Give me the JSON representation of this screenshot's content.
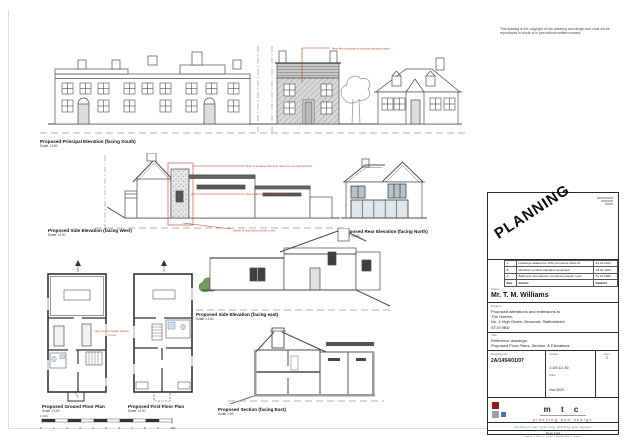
{
  "sheet": {
    "copyright_note": "This drawing is the copyright of mtc planning and design and must not be reproduced in whole or in part without written consent."
  },
  "panels": {
    "principal": {
      "title": "Proposed Principal Elevation (facing South)",
      "scale": "Scale 1:100",
      "annotation": "New flue terminal to existing chimney stack"
    },
    "side_west": {
      "title": "Proposed Side Elevation (facing West)",
      "scale": "Scale 1:100",
      "annotations": [
        "Roof of existing extension raised to suit new first floor",
        "New walls rendered to match existing",
        "Extent of new works shown in red"
      ]
    },
    "rear_north": {
      "title": "Proposed Rear Elevation (facing North)",
      "scale": "Scale 1:100"
    },
    "ground_floor": {
      "title": "Proposed Ground Floor Plan",
      "scale": "Scale 1:100"
    },
    "first_floor": {
      "title": "Proposed First Floor Plan",
      "scale": "Scale 1:100"
    },
    "side_east": {
      "title": "Proposed Side Elevation (facing east)",
      "scale": "Scale 1:100"
    },
    "section": {
      "title": "Proposed Section (facing East)",
      "scale": "Scale 1:50"
    },
    "plans_note": "line of new works shown in red"
  },
  "scale_bar": {
    "title": "1:100",
    "ticks": [
      "0",
      "1",
      "2",
      "3",
      "4",
      "5",
      "6",
      "7",
      "8",
      "9",
      "10m"
    ]
  },
  "title_block": {
    "stamp": "PLANNING",
    "revisions": {
      "rows": [
        {
          "rev": "C",
          "details": "Drawings adapted to LPA comments 2012-07",
          "date": "24.01.2021"
        },
        {
          "rev": "B",
          "details": "Windows to West elevation amended",
          "date": "13.01.2021"
        },
        {
          "rev": "A",
          "details": "Bathroom amended to combined shower room",
          "date": "04.12.2020"
        }
      ],
      "header": {
        "rev": "Rev",
        "details": "Details",
        "date": "Date/Int"
      }
    },
    "client_label": "Client:",
    "client_name": "Mr. T. M. Williams",
    "project_label": "Project:",
    "project_lines": [
      "Proposed alterations and extensions to",
      "The Homes,",
      "No. 4 High Green, Brewood, Staffordshire",
      "ST19 9BD"
    ],
    "title_label": "Title:",
    "title_lines": [
      "Reference drawings:",
      "Proposed Floor Plans, Section, & Elevations"
    ],
    "drawing_no_label": "Drawing No.",
    "drawing_no": "2A/1454/01/07",
    "scales_label": "Scales",
    "scales_value": "1:100 & 1:50",
    "date_label": "Date",
    "date_value": "Nov 2020",
    "rev_label": "Rev",
    "rev_value": "C",
    "logo": {
      "name": "m t c",
      "subtitle": "planning and design",
      "tagline": "certified   town planning   drafting and design"
    },
    "address_lines": [
      "Dean Fold",
      "Watling Street, Gailey, Staffordshire ST19",
      "Tel: 01902 000 000"
    ]
  },
  "colors": {
    "linework": "#4a4a4a",
    "annotation_red": "#c0392b",
    "logo_red": "#8c1d18",
    "logo_gray": "#9aa0a6",
    "logo_blue": "#4a6fb5",
    "fixture_blue": "#cfe0ea"
  }
}
